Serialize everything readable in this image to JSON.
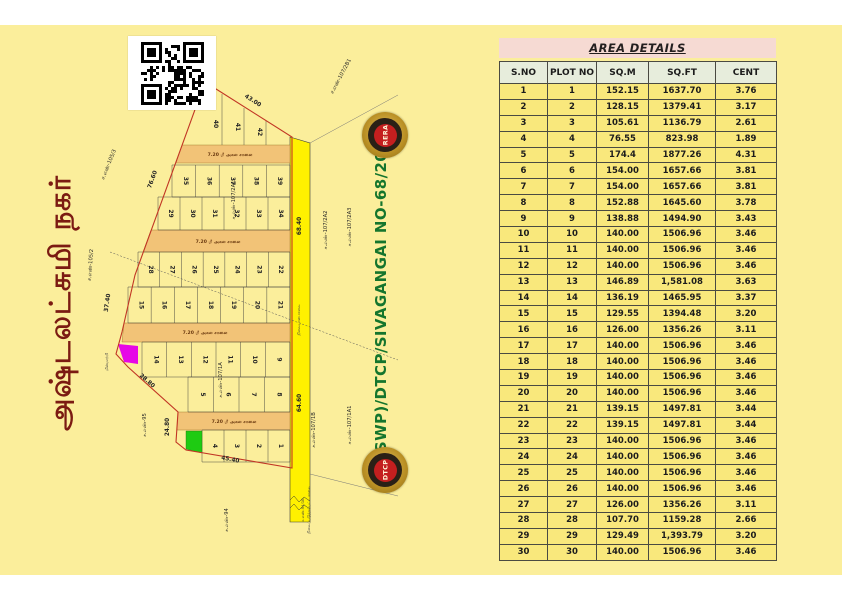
{
  "plan": {
    "title_tamil": "அஷ்டலட்சுமி நகர்",
    "approval_text": "L.P(SWP)/DTCP/SIVAGANGAI NO-68/2024",
    "survey_labels": [
      "ச.எண்-107/2B1",
      "ச.எண்-105/3",
      "ச.எண்-105/2",
      "ச.எண்-95",
      "ச.எண்-94",
      "ச.எண்-107/2A2",
      "ச.எண்-107/2A3",
      "ச.எண்-107/1A1",
      "ச.எண்-107/1B",
      "ச.எண்-107/2A1",
      "ச.எண்-107/1A"
    ],
    "dimensions": [
      "43.00",
      "76.60",
      "37.40",
      "28.80",
      "24.80",
      "45.40",
      "68.40",
      "64.60"
    ],
    "internal_road_label": "7.20 மீ அகல சாலை",
    "main_road_label": "நிலையான சாலை",
    "bottom_road_sno": "ச.எண்-94/1B",
    "bottom_road_name": "நிலைப்படுத்தப்பட்ட சாலை",
    "transformer_label": "மின்மாற்றி",
    "plot_rows": [
      {
        "plots": [
          "35",
          "36",
          "37",
          "38",
          "39"
        ]
      },
      {
        "plots": [
          "29",
          "30",
          "31",
          "32",
          "33",
          "34"
        ]
      },
      {
        "plots": [
          "28",
          "27",
          "26",
          "25",
          "24",
          "23",
          "22"
        ]
      },
      {
        "plots": [
          "15",
          "16",
          "17",
          "18",
          "19",
          "20",
          "21"
        ]
      },
      {
        "plots": [
          "14",
          "13",
          "12",
          "11",
          "10",
          "9"
        ]
      },
      {
        "plots": [
          "5",
          "6",
          "7",
          "8"
        ]
      },
      {
        "plots": [
          "4",
          "3",
          "2",
          "1"
        ]
      }
    ],
    "slant_plots": [
      "40",
      "41",
      "42"
    ]
  },
  "seals": {
    "top": "RERA",
    "bottom": "DTCP"
  },
  "table": {
    "title": "AREA DETAILS",
    "headers": [
      "S.NO",
      "PLOT NO",
      "SQ.M",
      "SQ.FT",
      "CENT"
    ],
    "rows": [
      [
        "1",
        "1",
        "152.15",
        "1637.70",
        "3.76"
      ],
      [
        "2",
        "2",
        "128.15",
        "1379.41",
        "3.17"
      ],
      [
        "3",
        "3",
        "105.61",
        "1136.79",
        "2.61"
      ],
      [
        "4",
        "4",
        "76.55",
        "823.98",
        "1.89"
      ],
      [
        "5",
        "5",
        "174.4",
        "1877.26",
        "4.31"
      ],
      [
        "6",
        "6",
        "154.00",
        "1657.66",
        "3.81"
      ],
      [
        "7",
        "7",
        "154.00",
        "1657.66",
        "3.81"
      ],
      [
        "8",
        "8",
        "152.88",
        "1645.60",
        "3.78"
      ],
      [
        "9",
        "9",
        "138.88",
        "1494.90",
        "3.43"
      ],
      [
        "10",
        "10",
        "140.00",
        "1506.96",
        "3.46"
      ],
      [
        "11",
        "11",
        "140.00",
        "1506.96",
        "3.46"
      ],
      [
        "12",
        "12",
        "140.00",
        "1506.96",
        "3.46"
      ],
      [
        "13",
        "13",
        "146.89",
        "1,581.08",
        "3.63"
      ],
      [
        "14",
        "14",
        "136.19",
        "1465.95",
        "3.37"
      ],
      [
        "15",
        "15",
        "129.55",
        "1394.48",
        "3.20"
      ],
      [
        "16",
        "16",
        "126.00",
        "1356.26",
        "3.11"
      ],
      [
        "17",
        "17",
        "140.00",
        "1506.96",
        "3.46"
      ],
      [
        "18",
        "18",
        "140.00",
        "1506.96",
        "3.46"
      ],
      [
        "19",
        "19",
        "140.00",
        "1506.96",
        "3.46"
      ],
      [
        "20",
        "20",
        "140.00",
        "1506.96",
        "3.46"
      ],
      [
        "21",
        "21",
        "139.15",
        "1497.81",
        "3.44"
      ],
      [
        "22",
        "22",
        "139.15",
        "1497.81",
        "3.44"
      ],
      [
        "23",
        "23",
        "140.00",
        "1506.96",
        "3.46"
      ],
      [
        "24",
        "24",
        "140.00",
        "1506.96",
        "3.46"
      ],
      [
        "25",
        "25",
        "140.00",
        "1506.96",
        "3.46"
      ],
      [
        "26",
        "26",
        "140.00",
        "1506.96",
        "3.46"
      ],
      [
        "27",
        "27",
        "126.00",
        "1356.26",
        "3.11"
      ],
      [
        "28",
        "28",
        "107.70",
        "1159.28",
        "2.66"
      ],
      [
        "29",
        "29",
        "129.49",
        "1,393.79",
        "3.20"
      ],
      [
        "30",
        "30",
        "140.00",
        "1506.96",
        "3.46"
      ]
    ]
  },
  "colors": {
    "canvas_yellow": "#FBEE9B",
    "road_yellow": "#FFF100",
    "internal_road_tan": "#F2C377",
    "boundary_red": "#C13524",
    "title_maroon": "#7B1B12",
    "approval_green": "#15752D",
    "table_title_pink": "#F6DAD3",
    "table_header_green": "#E7EDDC",
    "table_row_yellow": "#F9E87C",
    "highlight_magenta": "#E607E6",
    "highlight_green": "#1ECB12"
  }
}
